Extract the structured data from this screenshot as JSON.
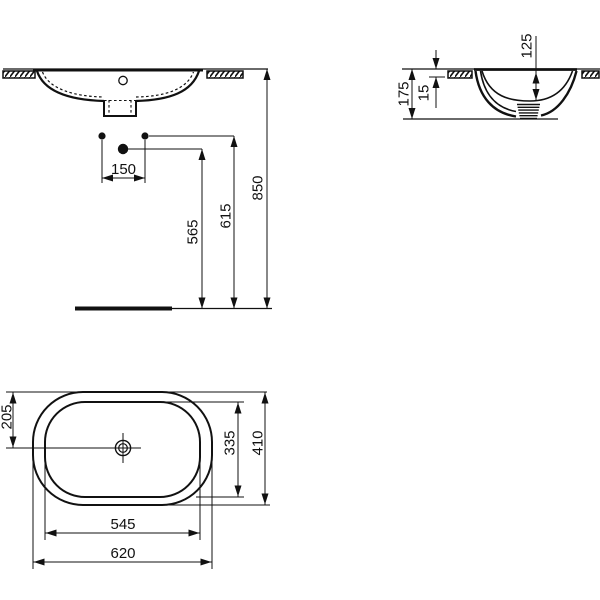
{
  "page": {
    "background_color": "#ffffff",
    "line_color": "#111111"
  },
  "dims": {
    "front": {
      "hole_spacing": "150",
      "trap_height": "565",
      "outlet_height": "615",
      "rim_height": "850"
    },
    "side": {
      "total_depth": "175",
      "rim_lip": "15",
      "bowl_depth": "125"
    },
    "plan": {
      "center_offset": "205",
      "inner_length": "335",
      "outer_length": "410",
      "inner_width": "545",
      "outer_width": "620"
    }
  }
}
